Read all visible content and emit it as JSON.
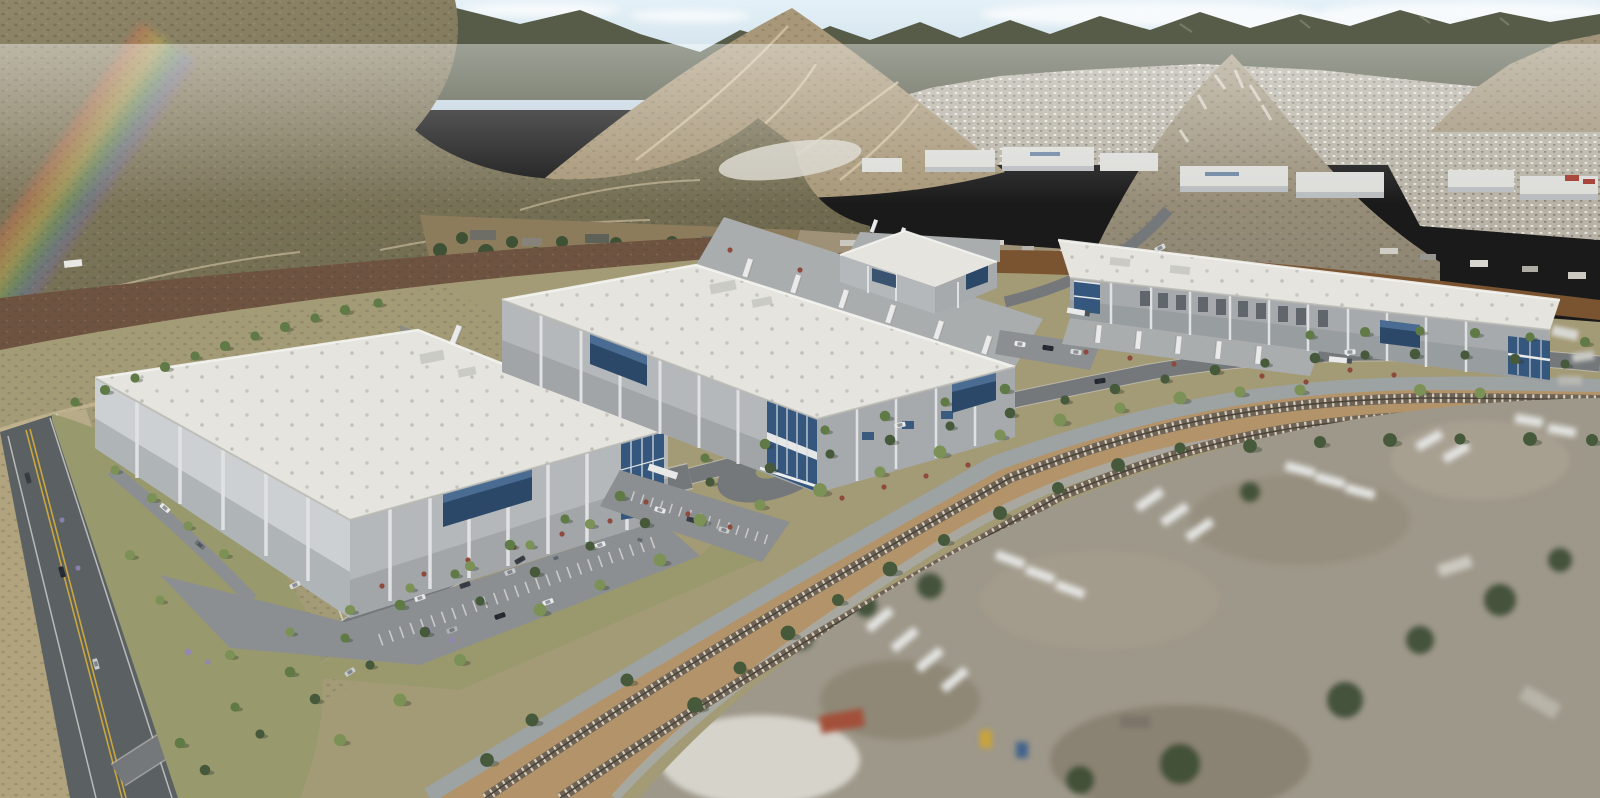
{
  "meta": {
    "title": "Aerial rendering of a four-building industrial logistics park",
    "type": "photorealistic-aerial-render",
    "no_visible_text": true,
    "description": "Rendered bird's-eye view of a new logistics park: four white tilt-up warehouses with blue glass office corners, truck courts with trailers, landscaped streets with trees and red shrubs, car parking lots, a public road with double-yellow centerline on the left, a two-track railroad on tan ballast sweeping diagonally across the lower right, blurred existing truck/trailer yards in the foreground, desert scrub fields, a junkyard strip mid-ground, and brown chaparral mountains with dirt trails and a distant valley town under a hazy sky with a faint rainbow lens flare upper-left."
  },
  "buildings": [
    {
      "id": "warehouse-1",
      "position": "front-left",
      "features": [
        "white roof with skylights",
        "gray tilt-up walls with white pilasters",
        "blue curtain-wall band",
        "glass entry at east corner",
        "truck court with trailers on northeast side",
        "car parking in front"
      ]
    },
    {
      "id": "warehouse-2",
      "position": "center",
      "features": [
        "largest footprint",
        "loading dock trailers on northeast side",
        "two-story glass office at south corner",
        "blue glass accent bands"
      ]
    },
    {
      "id": "warehouse-3",
      "position": "back-center",
      "features": [
        "smallest building",
        "blue accent bands",
        "trailers behind"
      ]
    },
    {
      "id": "warehouse-4",
      "position": "right",
      "features": [
        "dock doors along south face",
        "trailer parking on apron",
        "glass entries at both ends"
      ]
    }
  ],
  "transport": {
    "railroad": {
      "tracks": 2,
      "ballast": "tan with light cross-ties",
      "route": "diagonal from bottom-left to right edge"
    },
    "public_road": "left edge, double yellow centerline, 3 cars",
    "spine_road": "curving frontage road lined with street trees",
    "vehicles": "circa 40 cars, circa 25 semi trailers/trucks"
  },
  "context": {
    "background": "chaparral mountains, dirt trails, distant residential valley and white industrial buildings",
    "midground": "junkyard with dark trees, burned red-brown scrub, brown graded dirt band",
    "foreground": "blurred existing truck yards lower-right (tilt-shift effect)",
    "effects": [
      "rainbow lens flare upper-left",
      "atmospheric haze at horizon"
    ]
  },
  "palette": {
    "sky_top": "#e4f1f8",
    "sky_horizon": "#c3d4e0",
    "cloud": "#f7fafc",
    "ridge_dark": "#575c49",
    "peak_tan": "#a89778",
    "peak_rock": "#968b76",
    "ridge_right": "#a1947a",
    "mountain_hi": "#8f8568",
    "mountain_lo": "#6c674d",
    "mountain_speck": "#4c4d3a",
    "trail": "#d3c5a4",
    "city_base": "#b7b2a5",
    "city_dot": "#ebe9e2",
    "distant_roof": "#dcddd9",
    "distant_wall": "#b9bdbf",
    "junk_ground": "#8d7c5c",
    "junk_tree": "#3f5134",
    "scrub_burn": "#6e5340",
    "dirt_brown": "#7a5431",
    "ground_base": "#a39a76",
    "field_tan": "#b0a37d",
    "landscape_olive": "#99996e",
    "road_dark": "#5b6063",
    "road_mid": "#74787b",
    "curb": "#cbccc9",
    "lane_yellow": "#c9a63e",
    "parking": "#8c8f91",
    "stall": "#e8e9e9",
    "ballast": "#b3946a",
    "ballast_edge": "#9da2a2",
    "tie": "#d6cdb9",
    "rail": "#6e6356",
    "roof_white": "#e5e4df",
    "roof_dot": "#bdbcb7",
    "wall_lit": "#cdd0d2",
    "wall_mid": "#b4b8bb",
    "wall_shade": "#a6aaad",
    "wall_dark": "#8e9296",
    "pilaster": "#e0e1e2",
    "glass_navy": "#2c4868",
    "glass_blue": "#4d6f95",
    "glass_office": "#35577d",
    "apron": "#aaadae",
    "trailer_white": "#e9eae9",
    "cab_dark": "#4a5258",
    "tree_dark": "#46593a",
    "tree_mid": "#5f7a45",
    "tree_light": "#7b9155",
    "shrub_red": "#8e4a3c",
    "lavender": "#9384bb",
    "yard_ground": "#9e988a",
    "yard_white": "#e4e5e3",
    "haze": "#ffffff"
  }
}
